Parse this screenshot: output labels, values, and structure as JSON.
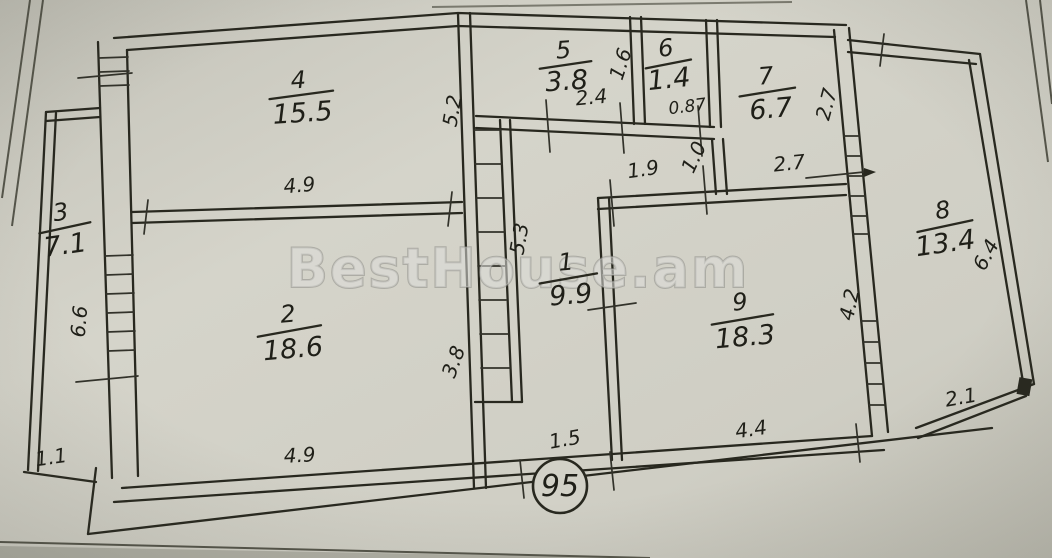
{
  "watermark": {
    "text": "BestHouse.am"
  },
  "plan_number": "95",
  "rooms": {
    "r1": {
      "number": "1",
      "area": "9.9"
    },
    "r2": {
      "number": "2",
      "area": "18.6"
    },
    "r3": {
      "number": "3",
      "area": "7.1"
    },
    "r4": {
      "number": "4",
      "area": "15.5"
    },
    "r5": {
      "number": "5",
      "area": "3.8"
    },
    "r6": {
      "number": "6",
      "area": "1.4"
    },
    "r7": {
      "number": "7",
      "area": "6.7"
    },
    "r8": {
      "number": "8",
      "area": "13.4"
    },
    "r9": {
      "number": "9",
      "area": "18.3"
    }
  },
  "dimensions": {
    "room4_bottom": "4.9",
    "central_upper_v": "5.2",
    "room5_bottom": "2.4",
    "room5_right_v": "1.6",
    "room6_bottom": "0.87",
    "room7_right_v": "2.7",
    "hall_top_left": "1.9",
    "hall_top_mid_v": "1.0",
    "hall_top_right": "2.7",
    "shaft_right_v": "5.3",
    "strip_left_v": "6.6",
    "central_lower_v": "3.8",
    "bottom_mid": "1.5",
    "room9_bottom": "4.4",
    "room9_right_v": "4.2",
    "loggia_right_v": "6.4",
    "loggia_bottom": "2.1",
    "room2_bottom": "4.9",
    "strip_bottom": "1.1"
  },
  "colors": {
    "paper": "#d2d1c7",
    "ink": "#28281f"
  }
}
